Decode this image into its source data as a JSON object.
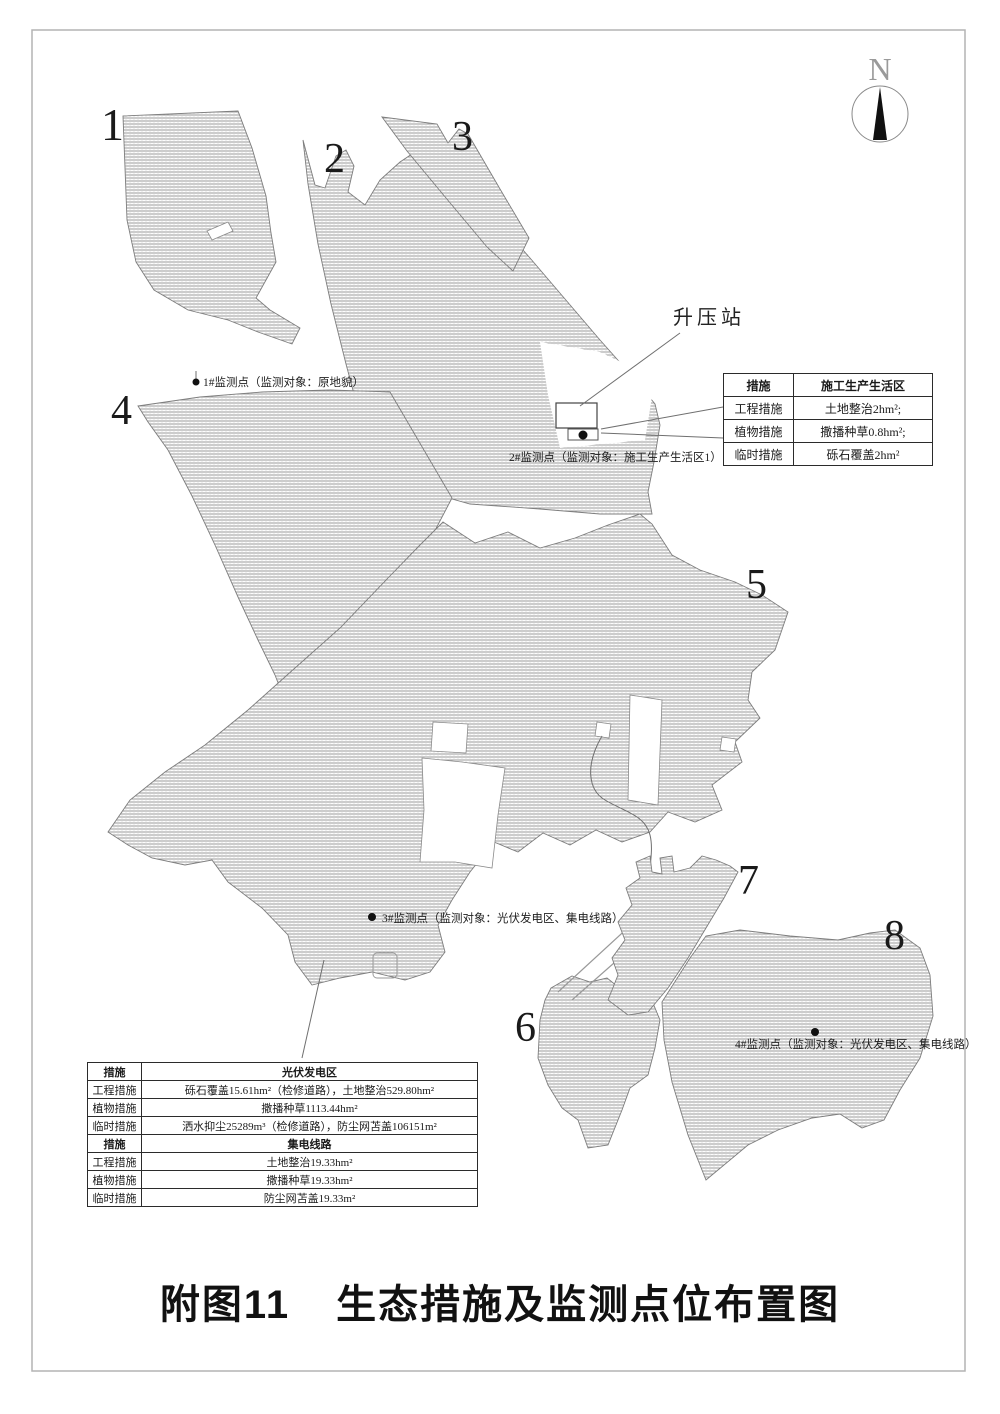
{
  "figure": {
    "title_prefix": "附图11",
    "title_main": "生态措施及监测点位布置图",
    "north_label": "N"
  },
  "map": {
    "region_labels": {
      "r1": "1",
      "r2": "2",
      "r3": "3",
      "r4": "4",
      "r5": "5",
      "r6": "6",
      "r7": "7",
      "r8": "8"
    },
    "booster_station_label": "升压站",
    "monitoring_points": {
      "p1": "1#监测点（监测对象：原地貌）",
      "p2": "2#监测点（监测对象：施工生产生活区1）",
      "p3": "3#监测点（监测对象：光伏发电区、集电线路）",
      "p4": "4#监测点（监测对象：光伏发电区、集电线路）"
    }
  },
  "tables": {
    "construction_living_area": {
      "col_measure": "措施",
      "col_area": "施工生产生活区",
      "rows": [
        {
          "measure": "工程措施",
          "value": "土地整治2hm²;"
        },
        {
          "measure": "植物措施",
          "value": "撒播种草0.8hm²;"
        },
        {
          "measure": "临时措施",
          "value": "砾石覆盖2hm²"
        }
      ]
    },
    "pv_and_collector": {
      "sections": [
        {
          "header_measure": "措施",
          "header_value": "光伏发电区",
          "rows": [
            {
              "measure": "工程措施",
              "value": "砾石覆盖15.61hm²（检修道路），土地整治529.80hm²"
            },
            {
              "measure": "植物措施",
              "value": "撒播种草1113.44hm²"
            },
            {
              "measure": "临时措施",
              "value": "洒水抑尘25289m³（检修道路），防尘网苫盖106151m²"
            }
          ]
        },
        {
          "header_measure": "措施",
          "header_value": "集电线路",
          "rows": [
            {
              "measure": "工程措施",
              "value": "土地整治19.33hm²"
            },
            {
              "measure": "植物措施",
              "value": "撒播种草19.33hm²"
            },
            {
              "measure": "临时措施",
              "value": "防尘网苫盖19.33m²"
            }
          ]
        }
      ]
    }
  }
}
